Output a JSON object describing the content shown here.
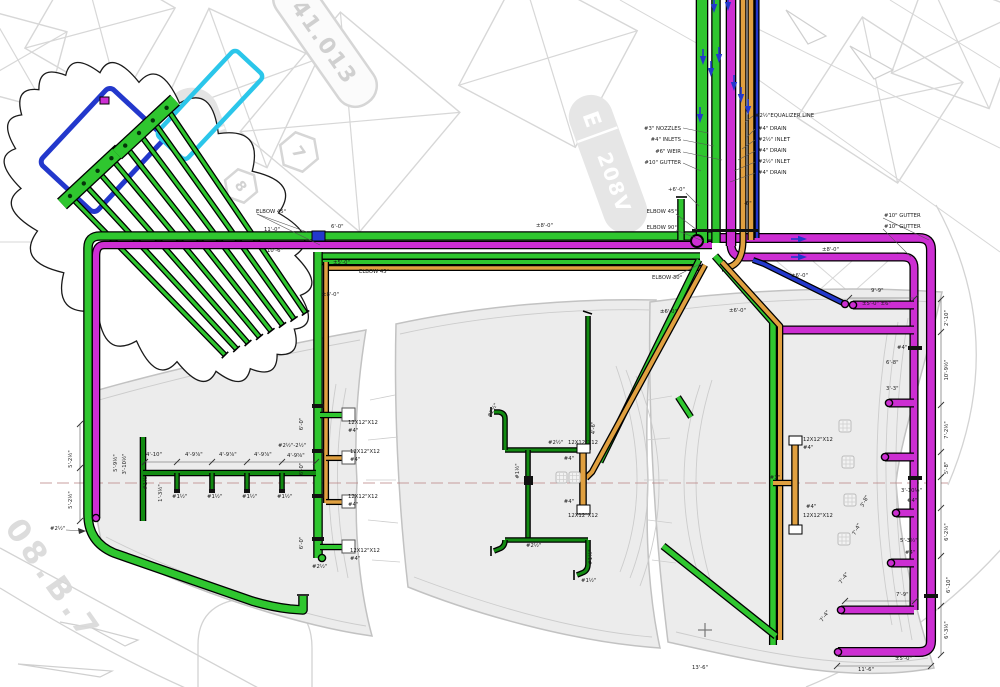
{
  "title": "Pool / fountain piping plan drawing",
  "colors": {
    "green": "#2fc62f",
    "dgreen": "#128a12",
    "magenta": "#cc2ed2",
    "orange": "#e0a040",
    "blue": "#2338cc",
    "cyan": "#2bc6ea",
    "dim": "#222222",
    "bg_line": "#d7d7d7",
    "pool_fill": "#ececec",
    "pool_line": "#c2c2c2",
    "centerline": "#b98080"
  },
  "background": {
    "pill_e": "E",
    "pill_v": "208V",
    "tag": "41.013",
    "hex_a": "7",
    "hex_b": "8",
    "watermark": "08.B.7"
  },
  "callouts": {
    "pipe_bundle_left": [
      "#3\" NOZZLES",
      "#4\" INLETS",
      "#6\" WEIR",
      "#10\" GUTTER"
    ],
    "pipe_bundle_right": [
      "#2½\"EQUALIZER LINE",
      "#4\" DRAIN",
      "#2½\" INLET",
      "#4\" DRAIN",
      "#2½\" INLET",
      "#4\" DRAIN"
    ]
  },
  "texts": [
    [
      "#3\" NOZZLES",
      681,
      130,
      0,
      2
    ],
    [
      "#4\" INLETS",
      681,
      141,
      0,
      2
    ],
    [
      "#6\" WEIR",
      681,
      153,
      0,
      2
    ],
    [
      "#10\" GUTTER",
      681,
      164,
      0,
      2
    ],
    [
      "#2½\"EQUALIZER LINE",
      755,
      117
    ],
    [
      "#4\" DRAIN",
      758,
      130
    ],
    [
      "#2½\" INLET",
      758,
      141
    ],
    [
      "#4\" DRAIN",
      758,
      152
    ],
    [
      "#2½\" INLET",
      758,
      163
    ],
    [
      "#4\" DRAIN",
      758,
      174
    ],
    [
      "ELBOW 45°",
      256,
      213
    ],
    [
      "11'-0\"",
      264,
      231
    ],
    [
      "6'-0\"",
      331,
      228
    ],
    [
      "10'-6\"",
      267,
      252
    ],
    [
      "±5'-0\"",
      333,
      264
    ],
    [
      "ELBOW 45°",
      359,
      273
    ],
    [
      "±8'-0\"",
      322,
      296
    ],
    [
      "±8'-0\"",
      536,
      227
    ],
    [
      "+6'-0\"",
      668,
      191
    ],
    [
      "ELBOW 45°",
      677,
      213,
      0,
      2
    ],
    [
      "ELBOW 90°",
      677,
      229,
      0,
      2
    ],
    [
      "-6\"",
      744,
      205
    ],
    [
      "ELBOW 30°",
      652,
      279
    ],
    [
      "±6'-0\"",
      660,
      313
    ],
    [
      "±6'-0\"",
      729,
      312
    ],
    [
      "±6'-0\"",
      791,
      277
    ],
    [
      "±8'-0\"",
      822,
      251
    ],
    [
      "#10\" GUTTER",
      884,
      217
    ],
    [
      "#10\" GUTTER",
      884,
      228
    ],
    [
      "9'-9\"",
      871,
      292
    ],
    [
      "±5'-0\" ±6\"",
      862,
      305
    ],
    [
      "#4\"",
      897,
      349
    ],
    [
      "6'-8\"",
      886,
      364
    ],
    [
      "3'-3\"",
      886,
      390
    ],
    [
      "2'-10\"",
      948,
      318,
      -90,
      1
    ],
    [
      "10'-9½\"",
      948,
      370,
      -90,
      1
    ],
    [
      "7'-2½\"",
      948,
      430,
      -90,
      1
    ],
    [
      "5'-8\"",
      948,
      468,
      -90,
      1
    ],
    [
      "6'-2½\"",
      948,
      532,
      -90,
      1
    ],
    [
      "6'-10\"",
      950,
      585,
      -90,
      1
    ],
    [
      "6'-3½\"",
      948,
      630,
      -90,
      1
    ],
    [
      "3'-10½\"",
      901,
      492
    ],
    [
      "#4\"",
      907,
      502
    ],
    [
      "5'-3½\"",
      900,
      542
    ],
    [
      "#4\"",
      905,
      554
    ],
    [
      "7'-9\"",
      896,
      596
    ],
    [
      "±5'-0\"",
      895,
      660
    ],
    [
      "11'-6\"",
      858,
      671
    ],
    [
      "3'-8\"",
      866,
      502,
      -62,
      1
    ],
    [
      "7'-4\"",
      858,
      530,
      -62,
      1
    ],
    [
      "7'-4\"",
      845,
      579,
      -55,
      1
    ],
    [
      "7'-4\"",
      826,
      617,
      -55,
      1
    ],
    [
      "13'-6\"",
      692,
      669
    ],
    [
      "5'-2½\"",
      72,
      459,
      -90,
      1
    ],
    [
      "5'-2½\"",
      72,
      500,
      -90,
      1
    ],
    [
      "#2½\"",
      50,
      530
    ],
    [
      "5'-9½\"",
      117,
      463,
      -90,
      1
    ],
    [
      "3'-10½\"",
      126,
      464,
      -90,
      1
    ],
    [
      "1'-3½\"",
      162,
      493,
      -90,
      1
    ],
    [
      "4'-10\"",
      146,
      456
    ],
    [
      "4'-9⅞\"",
      185,
      456
    ],
    [
      "4'-9⅞\"",
      219,
      456
    ],
    [
      "4'-9⅞\"",
      254,
      456
    ],
    [
      "4'-9⅝\"",
      287,
      457
    ],
    [
      "#2½\"-2½\"",
      278,
      447
    ],
    [
      "#1½\"",
      147,
      482,
      -90,
      1
    ],
    [
      "#1½\"",
      172,
      498
    ],
    [
      "#1½\"",
      207,
      498
    ],
    [
      "#1½\"",
      242,
      498
    ],
    [
      "#1½\"",
      277,
      498
    ],
    [
      "6'-0\"",
      303,
      424,
      -90,
      1
    ],
    [
      "6'-0\"",
      303,
      469,
      -90,
      1
    ],
    [
      "6'-0\"",
      303,
      543,
      -90,
      1
    ],
    [
      "12X12\"X12",
      348,
      424
    ],
    [
      "#4\"",
      348,
      432
    ],
    [
      "12X12\"X12",
      350,
      453
    ],
    [
      "#4\"",
      350,
      461
    ],
    [
      "12X12\"X12",
      348,
      498
    ],
    [
      "#4\"",
      348,
      506
    ],
    [
      "12X12\"X12",
      350,
      552
    ],
    [
      "#4\"",
      350,
      560
    ],
    [
      "#2½\"",
      312,
      568
    ],
    [
      "#2½\"",
      494,
      411,
      -62,
      1
    ],
    [
      "#2½\"",
      548,
      444
    ],
    [
      "#1½\"",
      519,
      471,
      -90,
      1
    ],
    [
      "12X12\"X12",
      583,
      444,
      0,
      1
    ],
    [
      "#4\"",
      574,
      460,
      0,
      2
    ],
    [
      "#4\"",
      574,
      503,
      0,
      2
    ],
    [
      "12X12\"X12",
      583,
      517,
      0,
      1
    ],
    [
      "4'-6\"",
      595,
      428,
      -90,
      1
    ],
    [
      "#1½\"",
      592,
      557,
      -90,
      1
    ],
    [
      "#1½\"",
      581,
      582
    ],
    [
      "#2½\"",
      526,
      547
    ],
    [
      "12X12\"X12",
      803,
      441
    ],
    [
      "#4\"",
      803,
      449
    ],
    [
      "#3\"",
      780,
      479,
      0,
      2
    ],
    [
      "#4\"",
      806,
      508
    ],
    [
      "12X12\"X12",
      803,
      517
    ]
  ]
}
